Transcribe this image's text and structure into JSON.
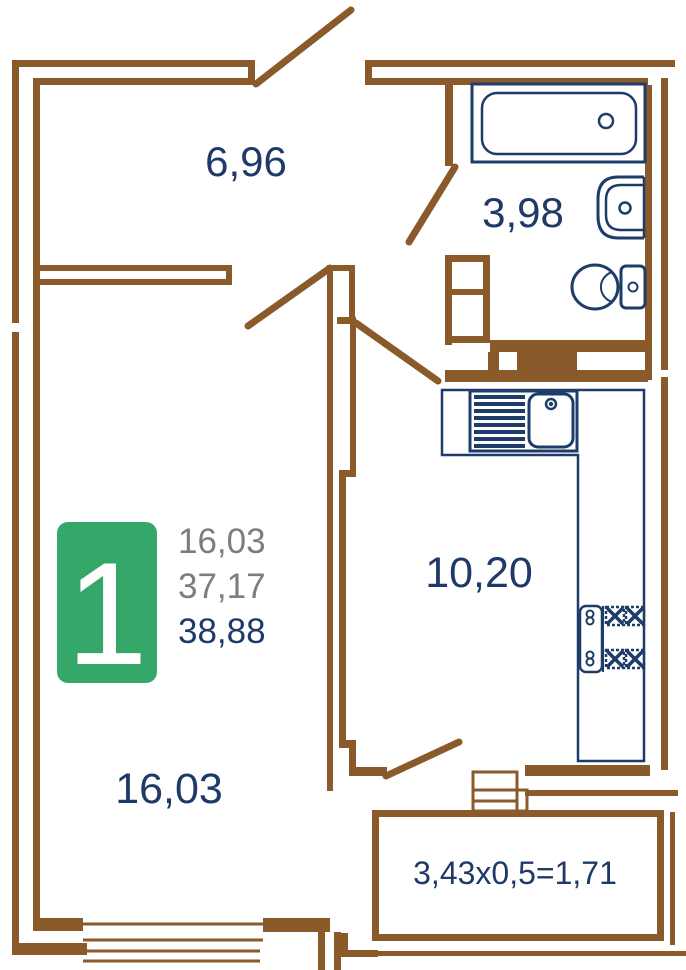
{
  "colors": {
    "wall": "#8a5a2b",
    "fixture": "#1e3c6a",
    "label": "#1f3a68",
    "muted": "#7d7d7d",
    "accent": "#35a768",
    "badge-text": "#ffffff",
    "background": "#ffffff"
  },
  "rooms": {
    "hallway": {
      "area": "6,96"
    },
    "bathroom": {
      "area": "3,98"
    },
    "kitchen": {
      "area": "10,20"
    },
    "living_room": {
      "area": "16,03"
    },
    "balcony": {
      "dimensions": "3,43x0,5=1,71"
    }
  },
  "badge": {
    "rooms_count": "1",
    "stats": {
      "living_area": "16,03",
      "area_no_balcony": "37,17",
      "total_area": "38,88"
    }
  },
  "fixtures": {
    "bathtub": "bathtub",
    "washbasin": "washbasin",
    "toilet": "toilet",
    "kitchen_sink": "kitchen sink with drainboard",
    "stove": "stove"
  }
}
